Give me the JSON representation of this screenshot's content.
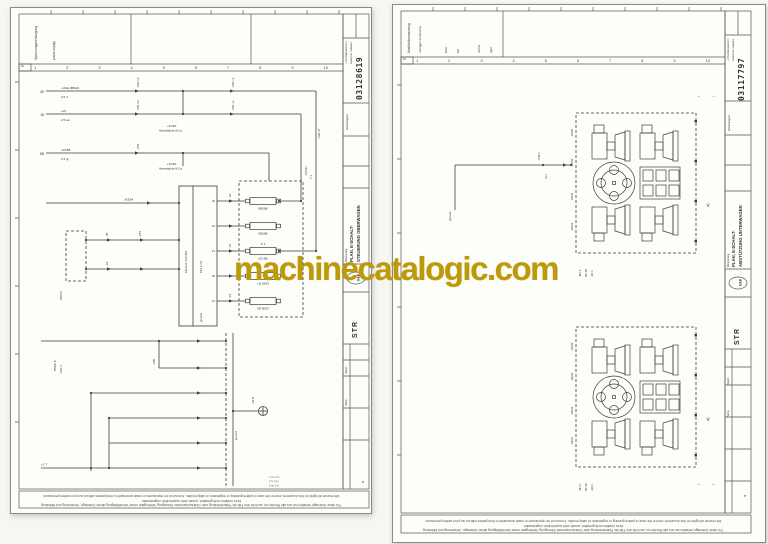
{
  "watermark": {
    "text": "machinecatalogic.com",
    "color": "#bd9a07",
    "style": "color:#bd9a07"
  },
  "left": {
    "ticks": [
      "1",
      "2",
      "3",
      "4",
      "5",
      "6",
      "7",
      "8",
      "9",
      "10"
    ],
    "nr_label": "Nr",
    "header": {
      "de": "Spannungsversorgung",
      "en": "power supply"
    },
    "buses": [
      {
        "id": "30",
        "top": "+Ubat (B60A)",
        "bot": "2.5 rt"
      },
      {
        "id": "15",
        "top": "+15",
        "bot": "2.5 sw"
      },
      {
        "id": "58",
        "top": "+15/58",
        "bot": "1.5 gr"
      }
    ],
    "labels": {
      "x53a": "-X53 12",
      "x53b": "-X53 +1",
      "x53c": "-X53",
      "x20": "-X20.37",
      "x70a": "-X70/17",
      "s71a": "7.1",
      "kvzf1": "+KVZF",
      "abz1": "Abzweigdose (K) Lp",
      "kvzf2": "+KVZF",
      "abz2": "Abzweigdose (K) Lp",
      "s58": "-S58 02",
      "s5": "-S5",
      "x2": "-X2",
      "k30": "(K30)A",
      "klemme": "Klemme 4 (K15)A",
      "k15": "K15 3.3 V",
      "ground_mod": "ground",
      "b550": "B550B",
      "b560": "B560B",
      "k2": "K 2",
      "k2ref": "(53.4B)",
      "q5k": "+Q 5K53",
      "r5k": "3R 5K53",
      "wire_tag": "-X1",
      "w47": "-47B",
      "b5wk": "B5WK E",
      "x26": "+X26 1",
      "t1": "+1 T",
      "ground_bus": "ground",
      "x2b": "-X2 B"
    },
    "pins": [
      "32",
      "31",
      "21",
      "26",
      "12"
    ],
    "legend": [
      "1 sw  2 br",
      "3 rt  4 ge",
      "5 gn  6 bl"
    ],
    "title_block": {
      "customer_de": "+) Kundenwunsch",
      "customer_en": "customer request",
      "number": "03128619",
      "number_label": "Zeichnungsnr.",
      "name_label": "Benennung",
      "title1": "PLAN, E-SCHALT-",
      "title2": "STEUERUNG OBERWAGEN",
      "logo": "O&K",
      "sheet": "STR",
      "field1": "Datum",
      "field2": "Name",
      "blatt": "Bl."
    },
    "footnote_de": "Für diese Unterlage behalten wir uns alle Rechte vor, auch für den Fall der Patenterteilung oder Gebrauchsmuster-Eintragung. Weitergabe sowie Vervielfältigung dieser Unterlage, Verwertung und Mitteilung ihres Inhaltes nicht gestattet, soweit nicht ausdrücklich zugestanden.",
    "footnote_en": "We reserve all rights for this document, even in the case of patent granting or registration of utility models. It must not be reproduced or made accessible to third parties without our prior written permission."
  },
  "right": {
    "ticks": [
      "1",
      "2",
      "3",
      "4",
      "5",
      "6",
      "7",
      "8",
      "9",
      "10"
    ],
    "nr_label": "Nr",
    "header": {
      "de": "Abstützüberwachung",
      "en": "outrigger monitoring",
      "i1": "links",
      "i2": "left",
      "i3": "rechts",
      "i4": "right"
    },
    "labels": {
      "ground": "ground",
      "x45": "-X45.1",
      "wire": "4×1",
      "b1p1": "-X45/4",
      "b1p2": "-X45/3",
      "b1p3": "-X45/2",
      "b1p4": "-X45/1",
      "b2p1": "-X46/4",
      "b2p2": "-X46/3",
      "b2p3": "-X46/2",
      "b2p4": "-X46/1",
      "b1t1": "-M1 2",
      "b1t2": "3R 4A",
      "b1t3": "-A6 1",
      "b2t1": "-M1 1",
      "b2t2": "3R 4A",
      "b2t3": "-A6 2",
      "ann1": "a)",
      "ann2": "a)",
      "chev_a": "›",
      "chev_b": "‹"
    },
    "title_block": {
      "customer_de": "+) Kundenwunsch",
      "customer_en": "customer request",
      "number": "03117797",
      "number_label": "Zeichnungsnr.",
      "name_label": "Benennung",
      "title1": "PLAN, E-SCHALT-",
      "title2": "ABSTÜTZUNG UNTERWAGEN",
      "logo": "O&K",
      "sheet": "STR",
      "field1": "Datum",
      "field2": "Name",
      "blatt": "Bl."
    },
    "footnote_de": "Für diese Unterlage behalten wir uns alle Rechte vor, auch für den Fall der Patenterteilung oder Gebrauchsmuster-Eintragung. Weitergabe sowie Vervielfältigung dieser Unterlage, Verwertung und Mitteilung ihres Inhaltes nicht gestattet, soweit nicht ausdrücklich zugestanden.",
    "footnote_en": "We reserve all rights for this document, even in the case of patent granting or registration of utility models. It must not be reproduced or made accessible to third parties without our prior written permission."
  }
}
